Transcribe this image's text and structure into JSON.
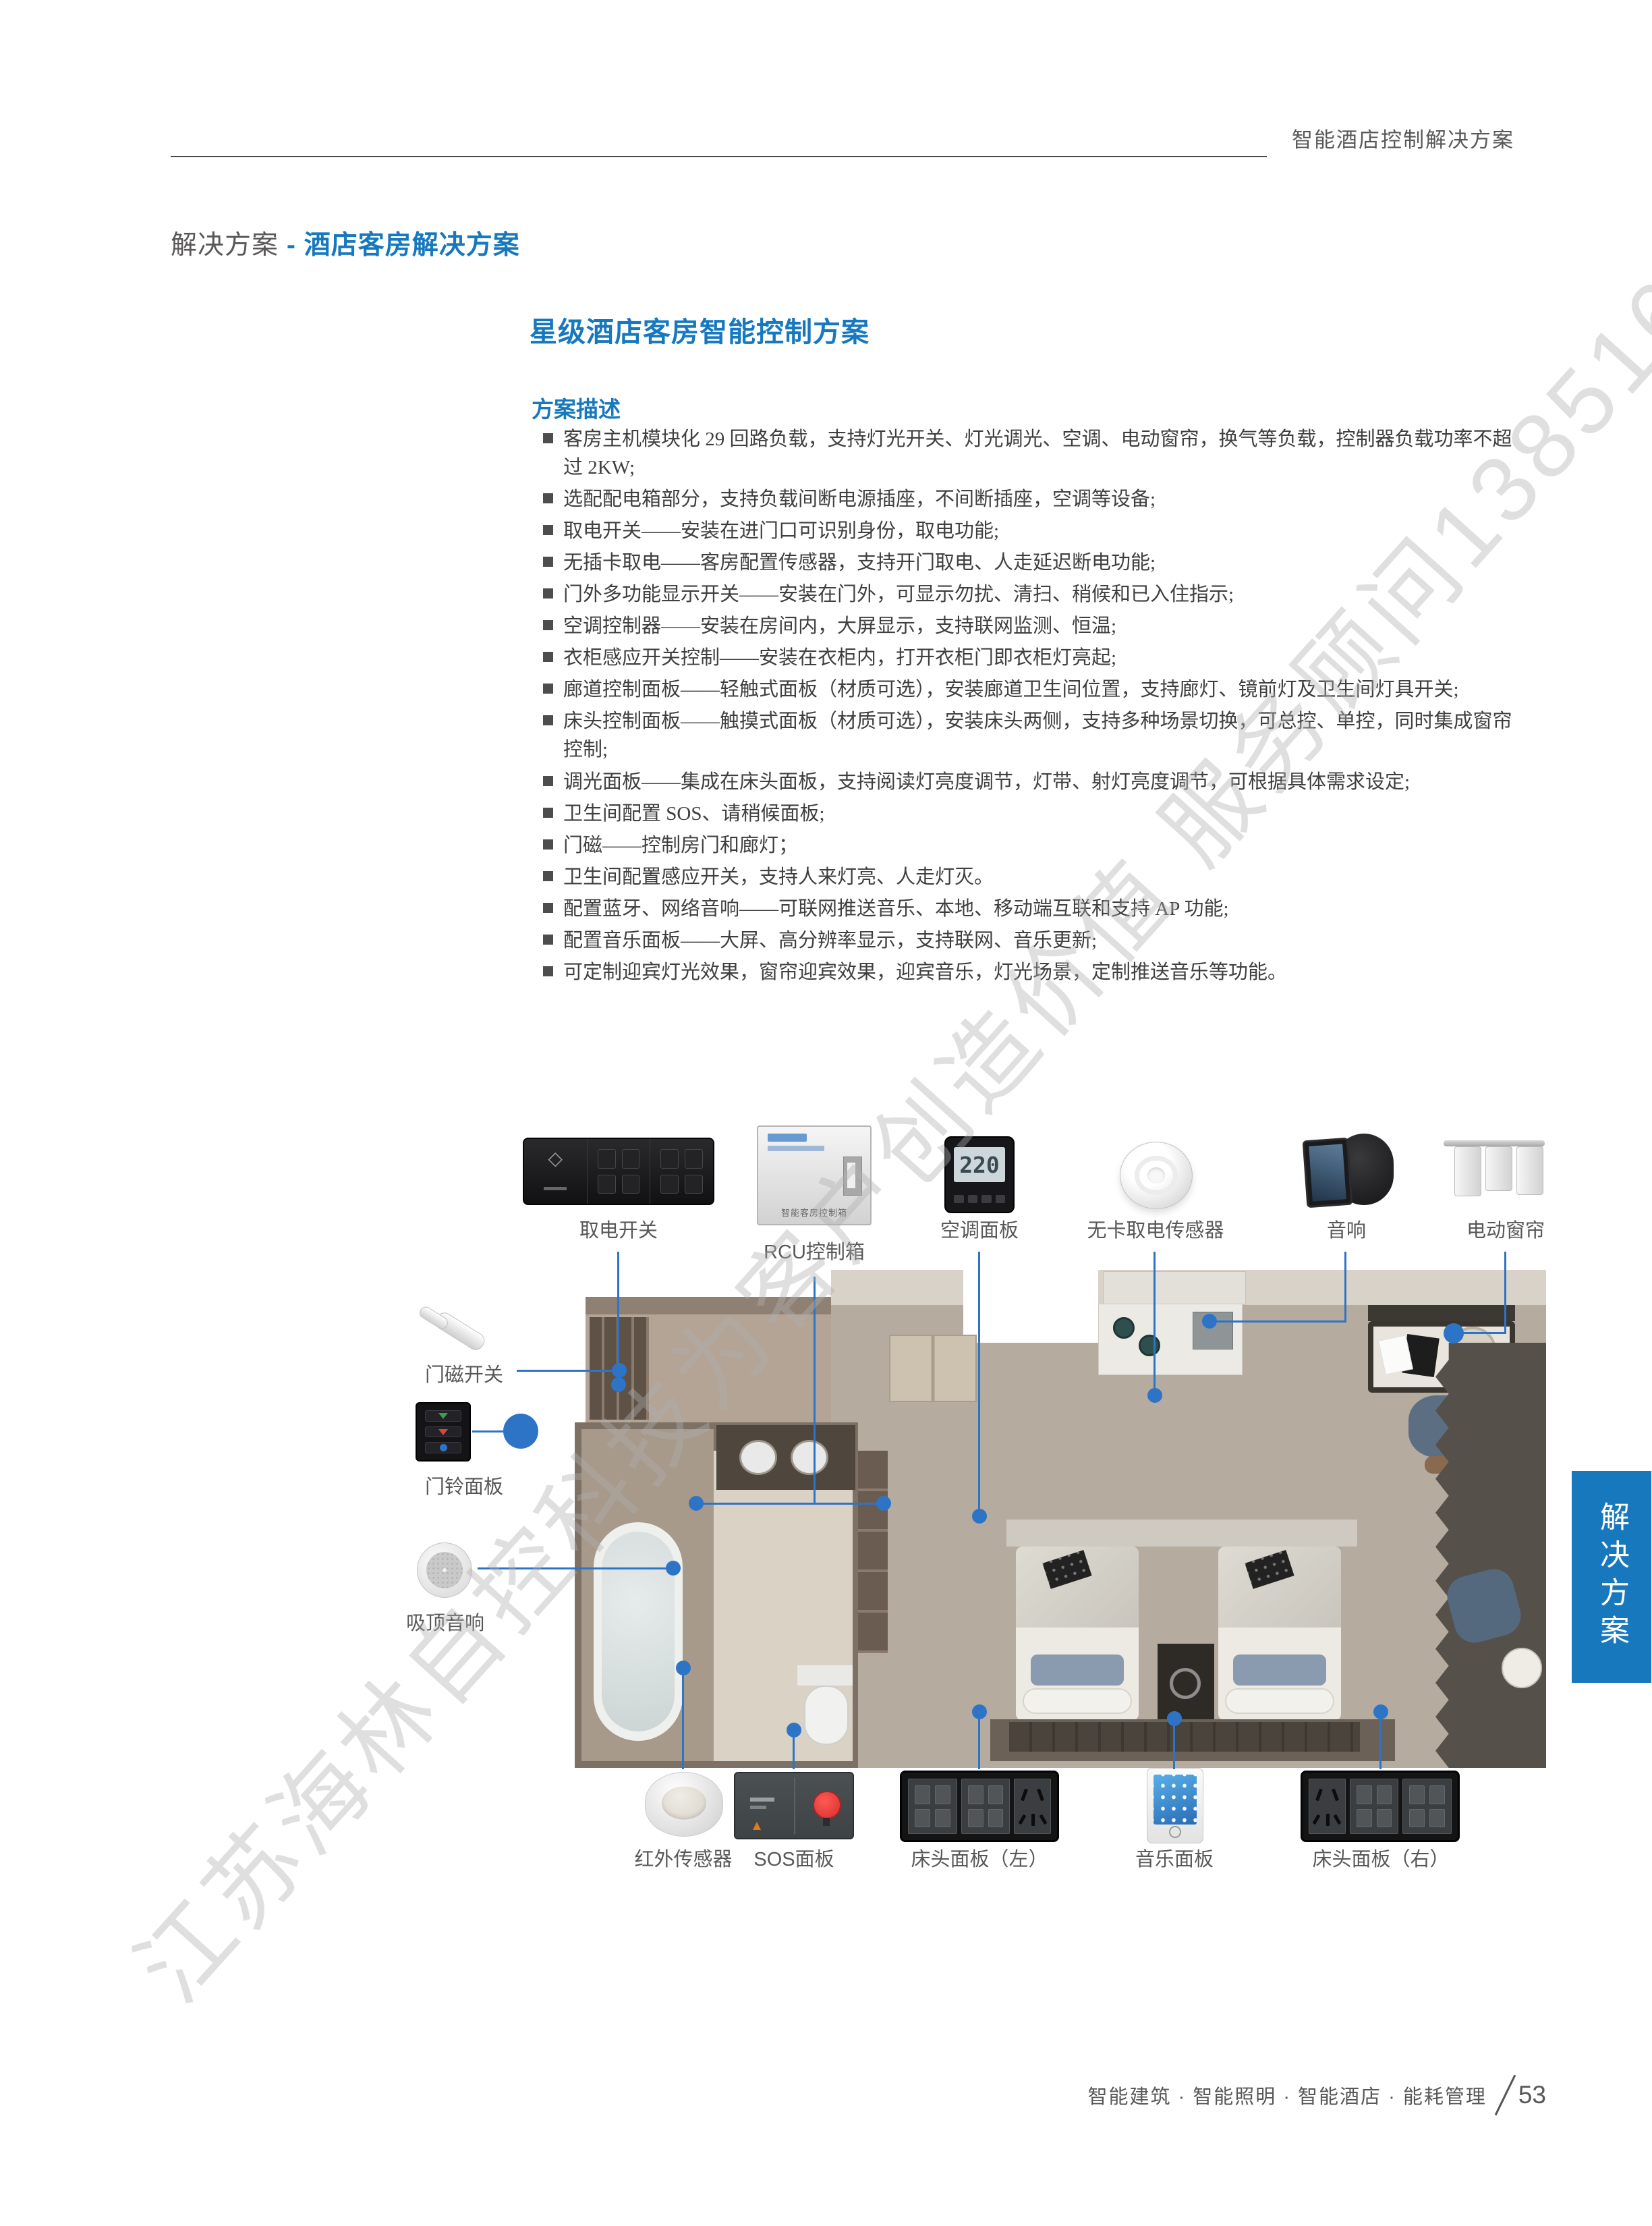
{
  "header": {
    "title": "智能酒店控制解决方案"
  },
  "breadcrumb": {
    "prefix": "解决方案",
    "separator": " - ",
    "current": "酒店客房解决方案"
  },
  "section_title": "星级酒店客房智能控制方案",
  "subsection_title": "方案描述",
  "bullets": [
    "客房主机模块化 29 回路负载，支持灯光开关、灯光调光、空调、电动窗帘，换气等负载，控制器负载功率不超过 2KW;",
    "选配配电箱部分，支持负载间断电源插座，不间断插座，空调等设备;",
    "取电开关——安装在进门口可识别身份，取电功能;",
    "无插卡取电——客房配置传感器，支持开门取电、人走延迟断电功能;",
    "门外多功能显示开关——安装在门外，可显示勿扰、清扫、稍候和已入住指示;",
    "空调控制器——安装在房间内，大屏显示，支持联网监测、恒温;",
    "衣柜感应开关控制——安装在衣柜内，打开衣柜门即衣柜灯亮起;",
    "廊道控制面板——轻触式面板（材质可选），安装廊道卫生间位置，支持廊灯、镜前灯及卫生间灯具开关;",
    "床头控制面板——触摸式面板（材质可选），安装床头两侧，支持多种场景切换，可总控、单控，同时集成窗帘控制;",
    "调光面板——集成在床头面板，支持阅读灯亮度调节，灯带、射灯亮度调节，可根据具体需求设定;",
    "卫生间配置 SOS、请稍候面板;",
    "门磁——控制房门和廊灯；",
    "卫生间配置感应开关，支持人来灯亮、人走灯灭。",
    "配置蓝牙、网络音响——可联网推送音乐、本地、移动端互联和支持 AP 功能;",
    "配置音乐面板——大屏、高分辨率显示，支持联网、音乐更新;",
    "可定制迎宾灯光效果，窗帘迎宾效果，迎宾音乐，灯光场景，定制推送音乐等功能。"
  ],
  "watermark": "江苏海林自控科技为客户创造价值 服务顾问13851623601",
  "side_tab": "解决方案",
  "footer": {
    "text": "智能建筑 · 智能照明 · 智能酒店 · 能耗管理",
    "page_number": "53"
  },
  "diagram": {
    "ac_display": "220",
    "rcu_text": "智能客房控制箱",
    "accent_blue": "#1678be",
    "connector_blue": "#2e74c6",
    "labels": {
      "power_switch": "取电开关",
      "rcu_box": "RCU控制箱",
      "ac_panel": "空调面板",
      "cardless_sensor": "无卡取电传感器",
      "speaker": "音响",
      "curtain": "电动窗帘",
      "door_magnet": "门磁开关",
      "doorbell": "门铃面板",
      "ceiling_speaker": "吸顶音响",
      "ir_sensor": "红外传感器",
      "sos_panel": "SOS面板",
      "bedside_left": "床头面板（左）",
      "music_panel": "音乐面板",
      "bedside_right": "床头面板（右）"
    }
  }
}
